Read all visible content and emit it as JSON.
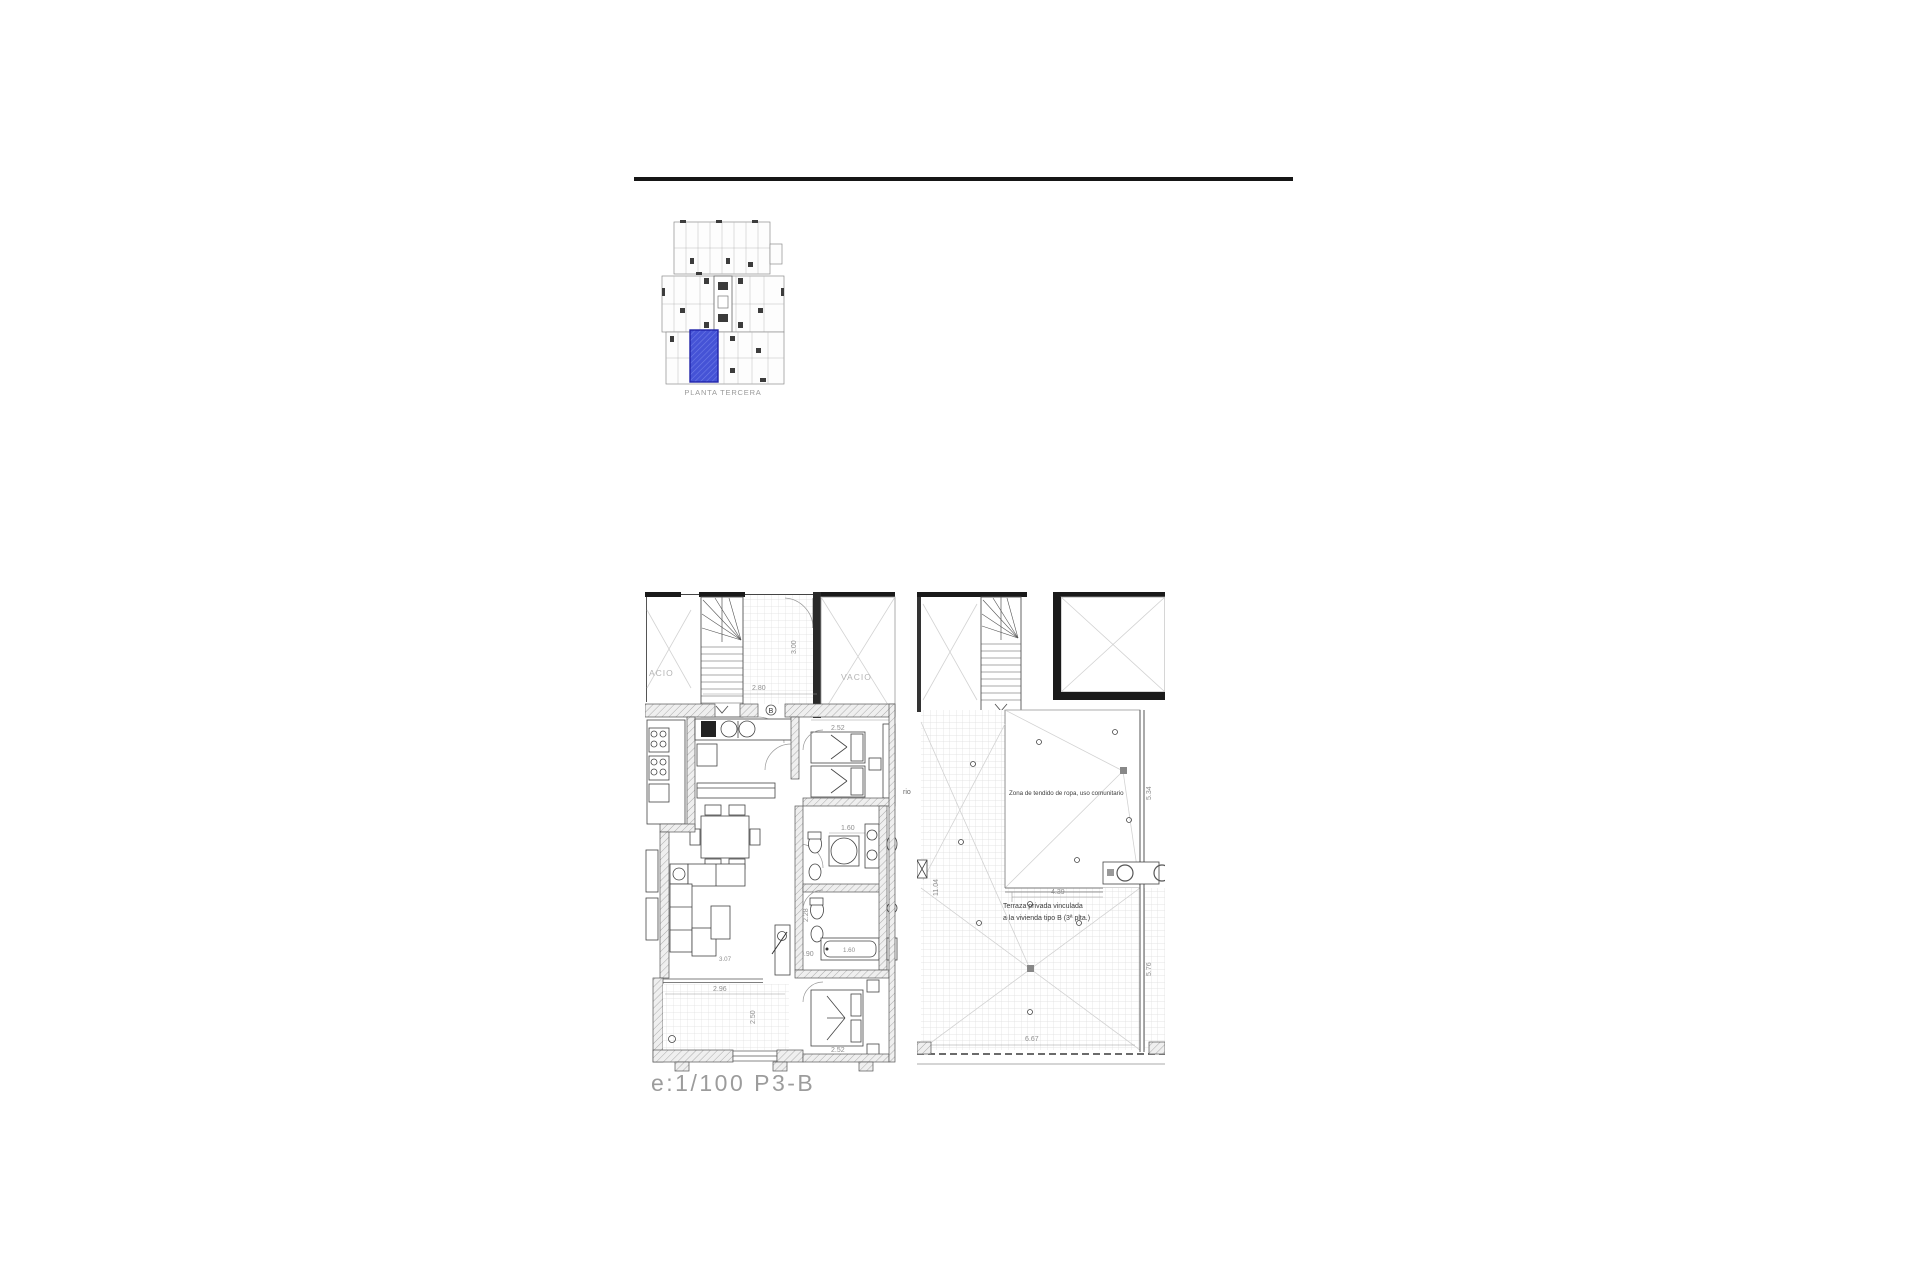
{
  "page": {
    "background": "#ffffff",
    "scale_label": "e:1/100  P3-B",
    "accent_blue": "#3f4ed2"
  },
  "key_plan": {
    "caption": "PLANTA TERCERA",
    "highlight_color": "#3f4ed2"
  },
  "left_plan": {
    "void_left": "ACIO",
    "void_right": "VACIO",
    "room_tag": "B",
    "dim_stair_width": "2.80",
    "dim_landing_depth": "3.00",
    "dim_bedroom1_width": "2.52",
    "dim_shower": "1.60",
    "dim_bath_depth": "2.28",
    "dim_bathtub": "1.60",
    "dim_hall": "0.90",
    "dim_living": "3.07",
    "dim_terrace_width": "2.96",
    "dim_terrace_depth": "2.50",
    "dim_bedroom2_width": "2.52"
  },
  "right_plan": {
    "dim_landing_width": "2.28",
    "zona_label": "Zona de tendido de ropa, uso comunitario",
    "dim_zona_depth": "5.45",
    "dim_zona_side": "5.34",
    "cut_text": "rio",
    "dim_terrace_height": "11.04",
    "dim_inner_width": "4.39",
    "terraza_line1": "Terraza privada vinculada",
    "terraza_line2": "a la vivienda tipo B (3ª plta.)",
    "dim_terrace_side": "5.76",
    "dim_terrace_width": "6.67"
  }
}
